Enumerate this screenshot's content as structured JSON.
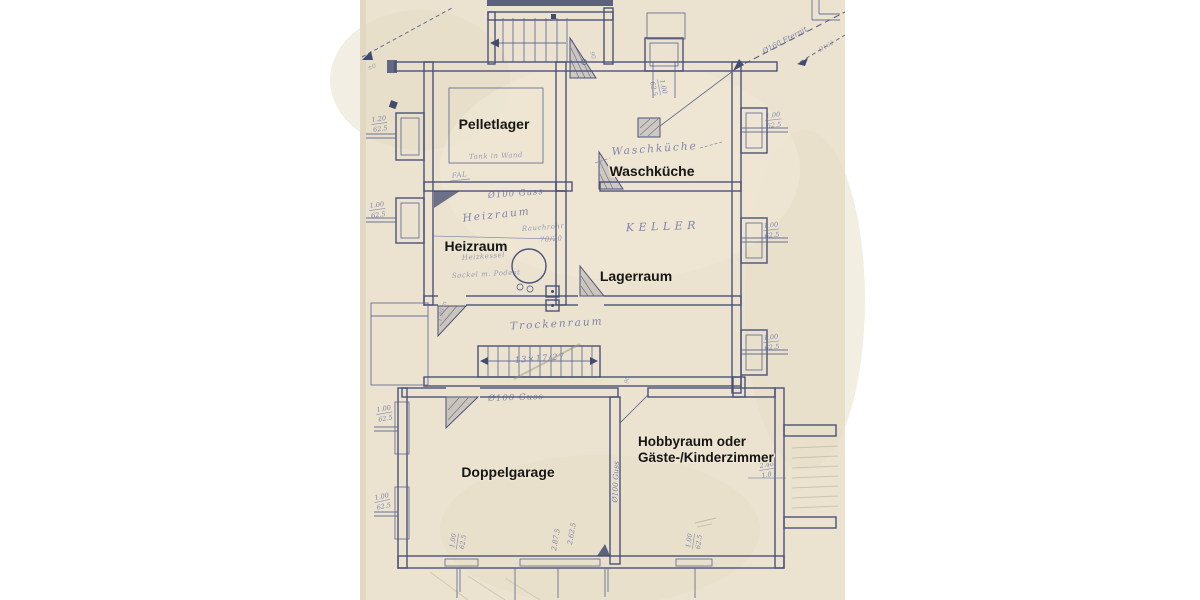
{
  "page": {
    "background": "#ffffff",
    "paper_color": "#ebe3cf",
    "ink_color": "#4b5278",
    "handwriting_color": "#6a73a4",
    "pencil_color": "#9d9780",
    "label_color": "#161616",
    "content": "basement floor plan blueprint scan"
  },
  "rooms": {
    "pelletlager": {
      "label": "Pelletlager"
    },
    "waschkueche": {
      "label": "Waschküche"
    },
    "heizraum": {
      "label": "Heizraum"
    },
    "lagerraum": {
      "label": "Lagerraum"
    },
    "doppelgarage": {
      "label": "Doppelgarage"
    },
    "hobbyraum": {
      "label_line1": "Hobbyraum oder",
      "label_line2": "Gäste-/Kinderzimmer"
    }
  },
  "handwritten": {
    "waschkueche_script": "Waschküche",
    "keller": "KELLER",
    "heizraum_script": "Heizraum",
    "rauchrohr": "Rauchrohr",
    "rauchrohr_dim": "70/20",
    "heizkessel": "Heizkessel",
    "sockel": "Sockel m. Podest",
    "tank": "Tank in Wand",
    "fal": "FAL",
    "trockenraum": "Trockenraum",
    "stair_formula": "13×17/27",
    "guss_heizraum": "Ø100 Guss",
    "guss_trockenraum": "Ø100 Guss",
    "guss_garage_wall": "Ø100 Guss",
    "eternit_pipe": "Ø160 Eternit",
    "eternit_pipe2": "Ø160",
    "level_mark": "±0",
    "door_angle": "90",
    "door_angle2": "90",
    "kessel_height": "1.30 m",
    "dim_2875": "2.87.5",
    "dim_2625": "2.62.5"
  },
  "window_dims": [
    {
      "w": "1.20",
      "h": "62.5"
    },
    {
      "w": "1.00",
      "h": "62.5"
    },
    {
      "w": "1.00",
      "h": "62.5"
    },
    {
      "w": "1.00",
      "h": "62.5"
    },
    {
      "w": "1.00",
      "h": "62.5"
    },
    {
      "w": "1.00",
      "h": "62.5"
    },
    {
      "w": "1.00",
      "h": "62.5"
    },
    {
      "w": "1.00",
      "h": "62.5"
    },
    {
      "w": "1.00",
      "h": "62.5"
    },
    {
      "w": "2.46",
      "h": "1.0"
    },
    {
      "w": "1.00",
      "h": "62.5"
    }
  ]
}
